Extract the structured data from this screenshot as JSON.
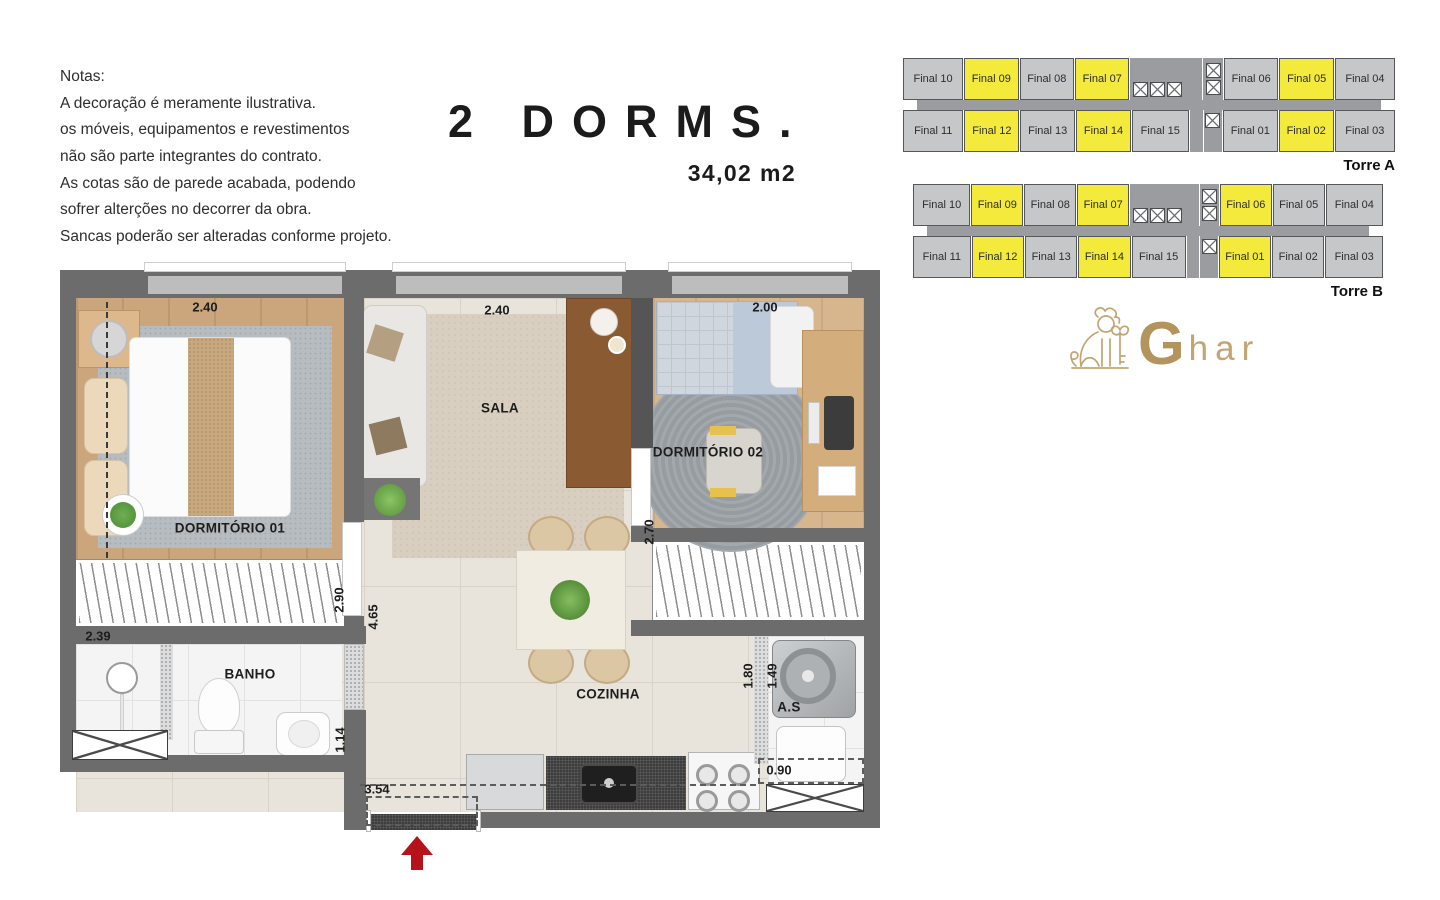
{
  "notes": {
    "title": "Notas:",
    "lines": [
      "A decoração é meramente ilustrativa.",
      "os móveis, equipamentos e revestimentos",
      "não são parte integrantes do contrato.",
      "As cotas são de parede acabada, podendo",
      "sofrer alterções no decorrer da obra.",
      "Sancas poderão ser alteradas conforme projeto."
    ]
  },
  "title": {
    "main": "2 DORMS.",
    "area": "34,02 m2"
  },
  "towers": [
    {
      "name": "Torre A",
      "rows": [
        [
          {
            "label": "Final 10",
            "type": "wide",
            "highlight": false
          },
          {
            "label": "Final 09",
            "type": "unit",
            "highlight": true
          },
          {
            "label": "Final 08",
            "type": "unit",
            "highlight": false
          },
          {
            "label": "Final 07",
            "type": "unit",
            "highlight": true
          },
          {
            "type": "core3"
          },
          {
            "type": "shaft2"
          },
          {
            "label": "Final 06",
            "type": "unit",
            "highlight": false
          },
          {
            "label": "Final 05",
            "type": "unit",
            "highlight": true
          },
          {
            "label": "Final 04",
            "type": "wide",
            "highlight": false
          }
        ],
        [
          {
            "label": "Final 11",
            "type": "wide",
            "highlight": false
          },
          {
            "label": "Final 12",
            "type": "unit",
            "highlight": true
          },
          {
            "label": "Final 13",
            "type": "unit",
            "highlight": false
          },
          {
            "label": "Final 14",
            "type": "unit",
            "highlight": true
          },
          {
            "label": "Final 15",
            "type": "unit15",
            "highlight": false
          },
          {
            "type": "gap"
          },
          {
            "type": "shaft1"
          },
          {
            "label": "Final 01",
            "type": "unit",
            "highlight": false
          },
          {
            "label": "Final 02",
            "type": "unit",
            "highlight": true
          },
          {
            "label": "Final 03",
            "type": "wide",
            "highlight": false
          }
        ]
      ]
    },
    {
      "name": "Torre B",
      "rows": [
        [
          {
            "label": "Final 10",
            "type": "wide",
            "highlight": false
          },
          {
            "label": "Final 09",
            "type": "unit",
            "highlight": true
          },
          {
            "label": "Final 08",
            "type": "unit",
            "highlight": false
          },
          {
            "label": "Final 07",
            "type": "unit",
            "highlight": true
          },
          {
            "type": "core3"
          },
          {
            "type": "shaft2"
          },
          {
            "label": "Final 06",
            "type": "unit",
            "highlight": true
          },
          {
            "label": "Final 05",
            "type": "unit",
            "highlight": false
          },
          {
            "label": "Final 04",
            "type": "wide",
            "highlight": false
          }
        ],
        [
          {
            "label": "Final 11",
            "type": "wide",
            "highlight": false
          },
          {
            "label": "Final 12",
            "type": "unit",
            "highlight": true
          },
          {
            "label": "Final 13",
            "type": "unit",
            "highlight": false
          },
          {
            "label": "Final 14",
            "type": "unit",
            "highlight": true
          },
          {
            "label": "Final 15",
            "type": "unit15",
            "highlight": false
          },
          {
            "type": "gap"
          },
          {
            "type": "shaft1"
          },
          {
            "label": "Final 01",
            "type": "unit",
            "highlight": true
          },
          {
            "label": "Final 02",
            "type": "unit",
            "highlight": false
          },
          {
            "label": "Final 03",
            "type": "wide",
            "highlight": false
          }
        ]
      ]
    }
  ],
  "logo": {
    "brand_bold": "G",
    "brand_light": "har",
    "icon": "lion-with-key-icon"
  },
  "plan": {
    "labels": [
      {
        "text": "2.40",
        "x": 145,
        "y": 37,
        "rot": false,
        "kind": "dim"
      },
      {
        "text": "2.40",
        "x": 437,
        "y": 40,
        "rot": false,
        "kind": "dim"
      },
      {
        "text": "2.00",
        "x": 705,
        "y": 37,
        "rot": false,
        "kind": "dim"
      },
      {
        "text": "DORMITÓRIO 01",
        "x": 170,
        "y": 258,
        "rot": false,
        "kind": "room"
      },
      {
        "text": "SALA",
        "x": 440,
        "y": 138,
        "rot": false,
        "kind": "room"
      },
      {
        "text": "DORMITÓRIO 02",
        "x": 648,
        "y": 182,
        "rot": false,
        "kind": "room"
      },
      {
        "text": "2.70",
        "x": 589,
        "y": 262,
        "rot": true,
        "kind": "dim"
      },
      {
        "text": "2.39",
        "x": 38,
        "y": 366,
        "rot": false,
        "kind": "dim"
      },
      {
        "text": "BANHO",
        "x": 190,
        "y": 404,
        "rot": false,
        "kind": "room"
      },
      {
        "text": "2.90",
        "x": 279,
        "y": 330,
        "rot": true,
        "kind": "dim"
      },
      {
        "text": "4.65",
        "x": 313,
        "y": 347,
        "rot": true,
        "kind": "dim"
      },
      {
        "text": "1.14",
        "x": 280,
        "y": 470,
        "rot": true,
        "kind": "dim"
      },
      {
        "text": "COZINHA",
        "x": 548,
        "y": 424,
        "rot": false,
        "kind": "room"
      },
      {
        "text": "1.80",
        "x": 688,
        "y": 406,
        "rot": true,
        "kind": "dim"
      },
      {
        "text": "1.49",
        "x": 712,
        "y": 406,
        "rot": true,
        "kind": "dim"
      },
      {
        "text": "A.S",
        "x": 729,
        "y": 437,
        "rot": false,
        "kind": "room"
      },
      {
        "text": "0.90",
        "x": 719,
        "y": 500,
        "rot": false,
        "kind": "dim"
      },
      {
        "text": "3.54",
        "x": 317,
        "y": 519,
        "rot": false,
        "kind": "dim"
      }
    ],
    "entrance_arrow_direction": "up"
  },
  "colors": {
    "unit_gray": "#c6c7c9",
    "unit_yellow": "#f3ea3b",
    "corridor": "#9b9c9f",
    "wall": "#6c6c6c",
    "gold": "#bb9c66",
    "arrow_red": "#b5121b"
  }
}
